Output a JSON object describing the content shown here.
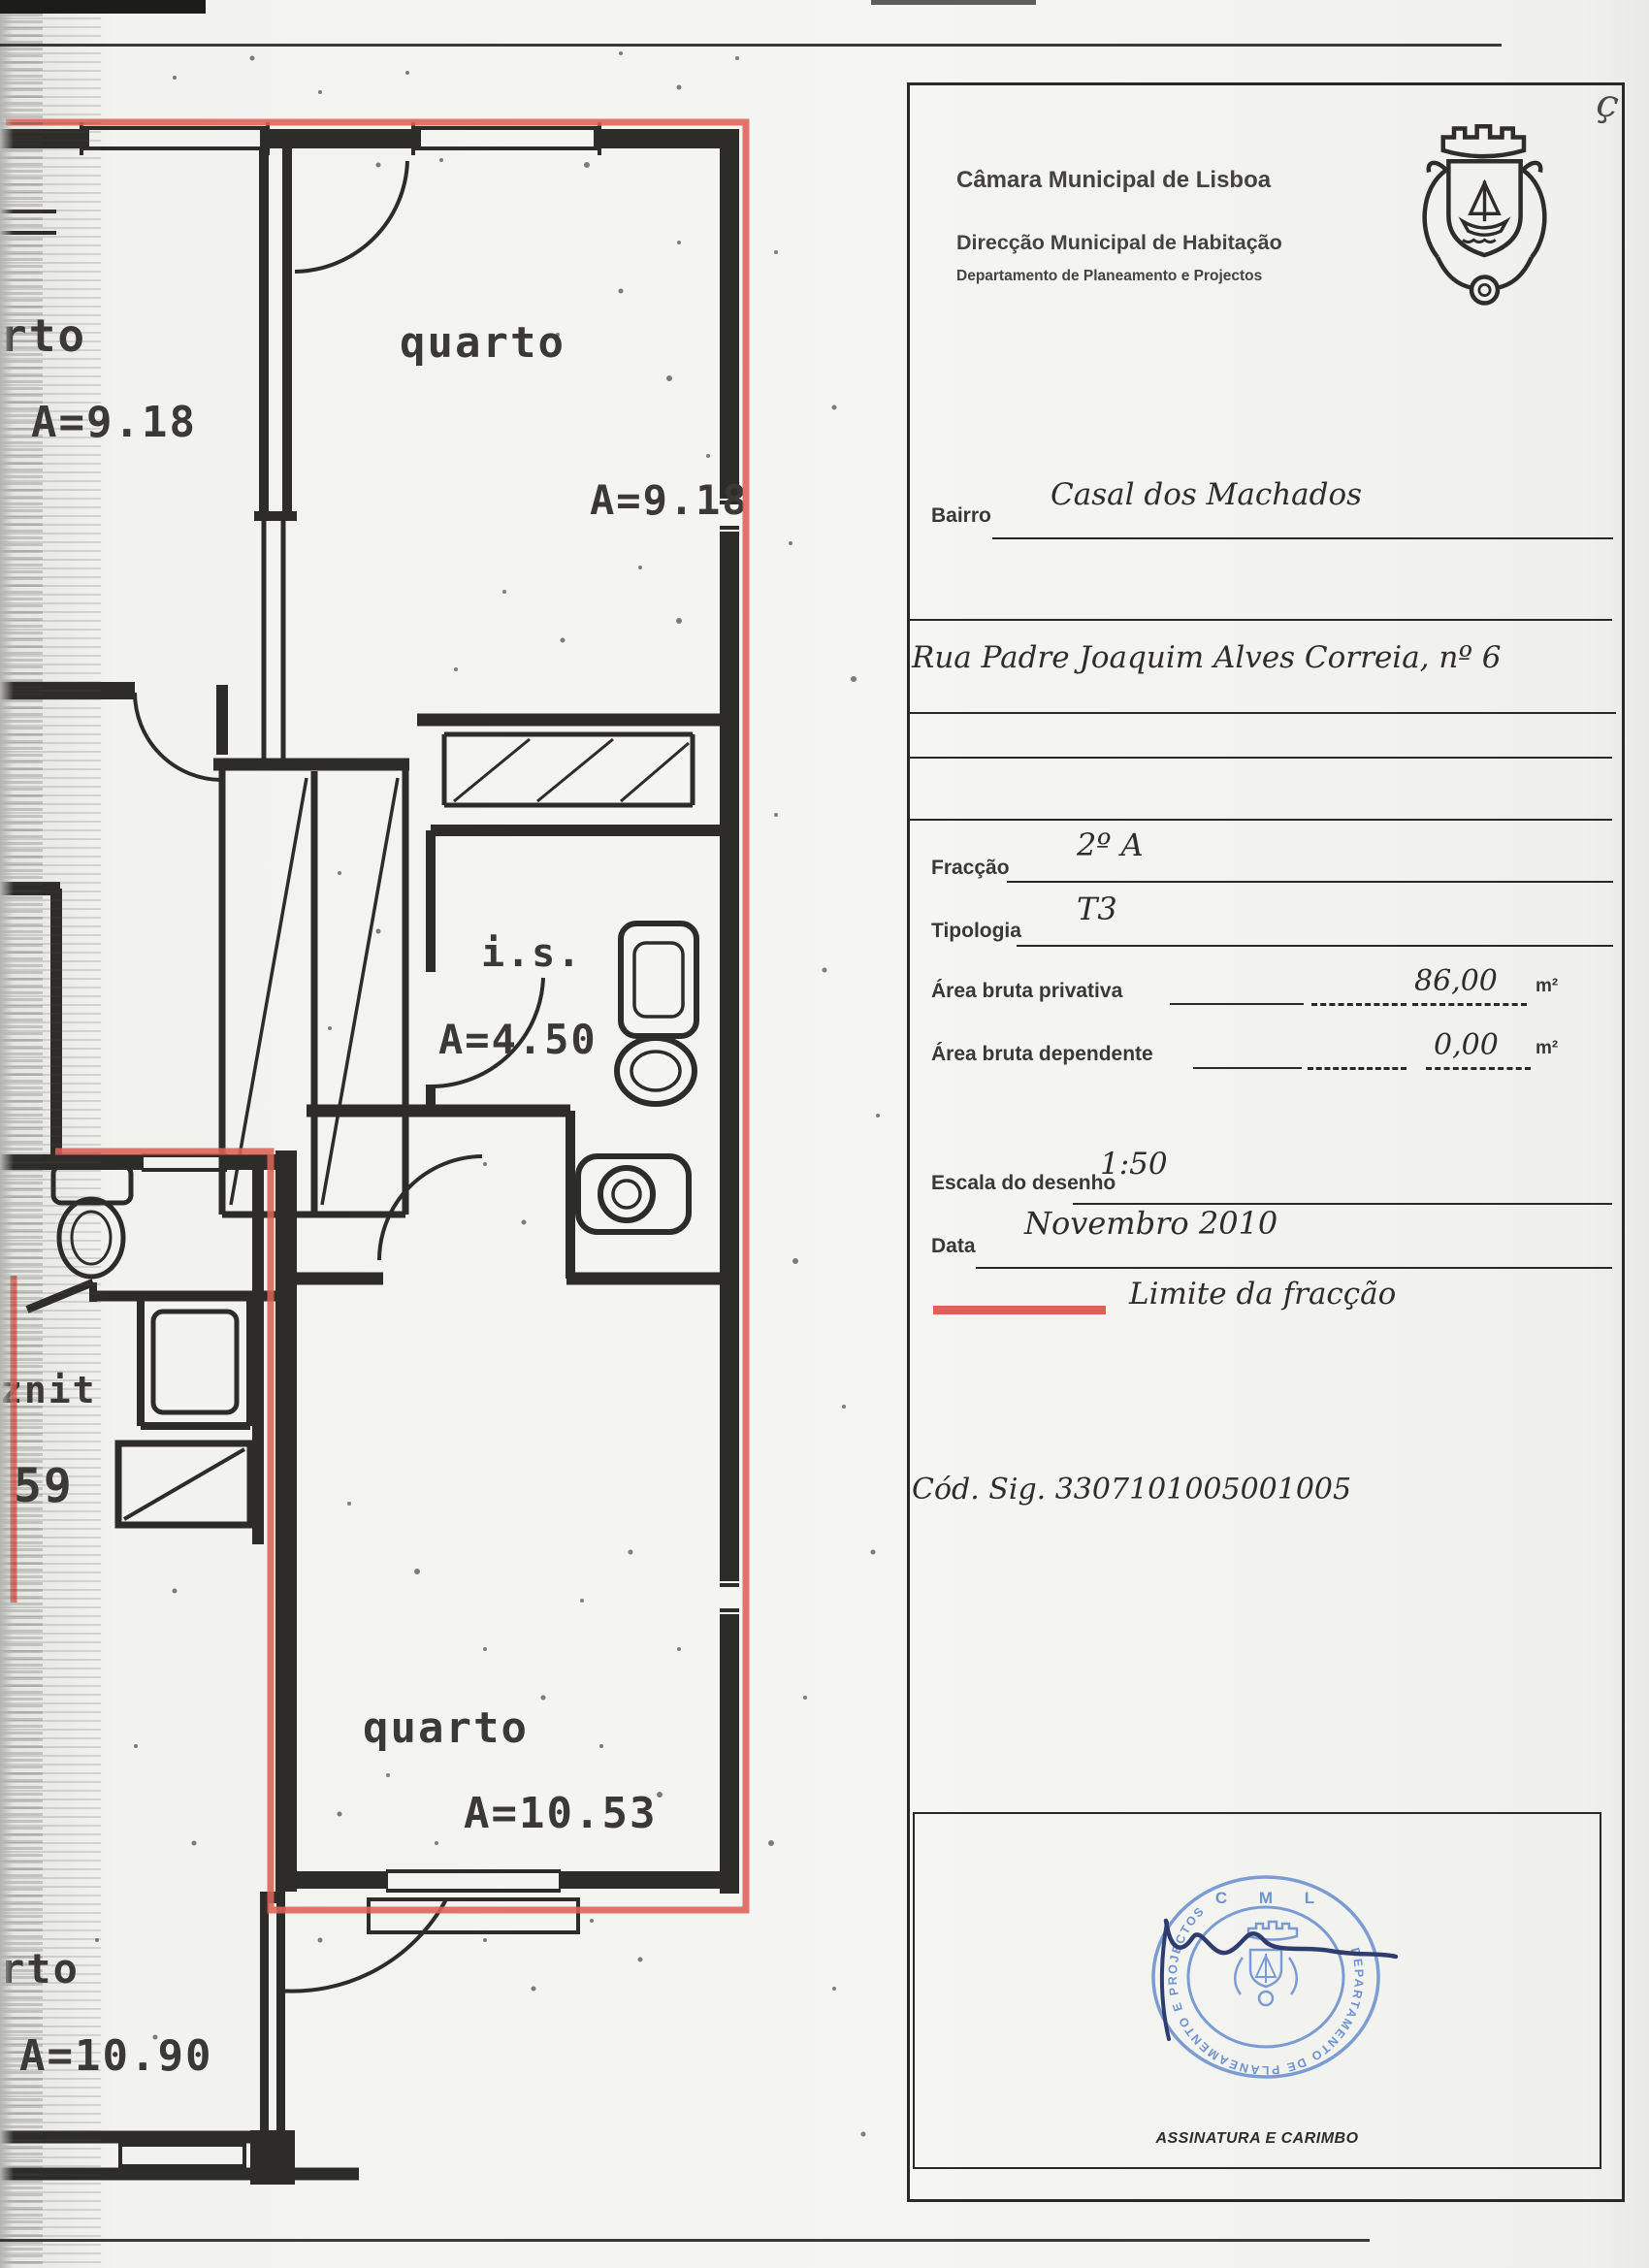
{
  "scan": {
    "pen_mark": "ç"
  },
  "colors": {
    "limit_red": "#dd6157",
    "stamp_blue": "#6f93cf",
    "signature_ink": "#2e3d6e",
    "line_ink": "#2e2c28"
  },
  "plan": {
    "rooms": {
      "top_left_label": "rto",
      "top_left_area": "A=9.18",
      "top_right_label": "quarto",
      "top_right_area": "A=9.18",
      "bathroom_label": "i.s.",
      "bathroom_area": "A=4.50",
      "bottom_label": "quarto",
      "bottom_area": "A=10.53",
      "bottom_left_label": "rto",
      "bottom_left_area": "A=10.90",
      "wc_label": "znit",
      "wc_area": "59"
    }
  },
  "panel": {
    "org_line1": "Câmara Municipal de Lisboa",
    "org_line2": "Direcção Municipal de Habitação",
    "org_line3": "Departamento de Planeamento e Projectos",
    "fields": {
      "bairro_label": "Bairro",
      "bairro_value": "Casal dos Machados",
      "address_value": "Rua Padre Joaquim Alves Correia, nº 6",
      "fraccao_label": "Fracção",
      "fraccao_value": "2º A",
      "tipologia_label": "Tipologia",
      "tipologia_value": "T3",
      "area_privativa_label": "Área bruta privativa",
      "area_privativa_value": "86,00",
      "area_privativa_unit": "m²",
      "area_dependente_label": "Área bruta dependente",
      "area_dependente_value": "0,00",
      "area_dependente_unit": "m²",
      "escala_label": "Escala do desenho",
      "escala_value": "1:50",
      "data_label": "Data",
      "data_value": "Novembro 2010"
    },
    "legend_label": "Limite da fracção",
    "cod_sig": "Cód. Sig. 3307101005001005",
    "signature_caption": "ASSINATURA E CARIMBO",
    "stamp": {
      "top_text": "C M L",
      "ring_text": "DEPARTAMENTO DE PLANEAMENTO E PROJECTOS"
    }
  }
}
